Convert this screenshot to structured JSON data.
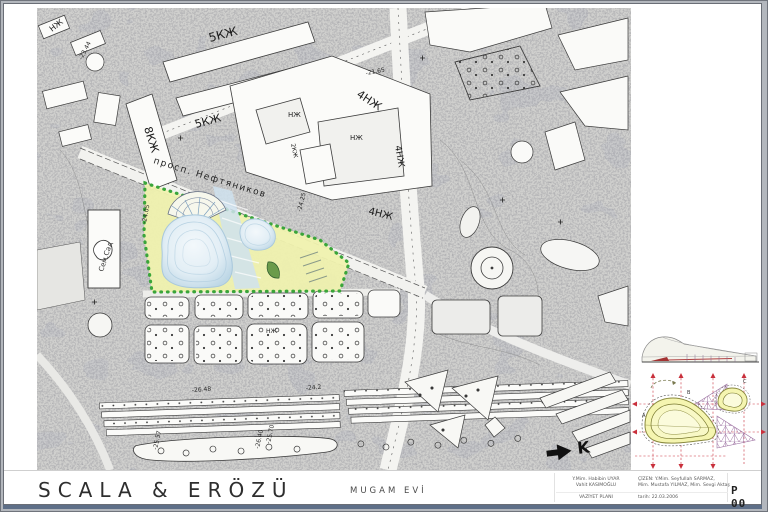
{
  "titleblock": {
    "firm": "SCALA & ERÖZÜ",
    "project": "MUGAM EVİ",
    "credits": {
      "left1": "Y.Mim. Habibin UYAR",
      "left2": "Vahit KASIMOĞLU",
      "left3": "VAZİYET PLANI",
      "right1": "ÇİZEN:  Y.Mim. Seyfullah SARMAZ,",
      "right2": "Mim. Mustafa YILMAZ, Mim. Sevgi Aktaş",
      "right3": "tarih: 22.03.2006"
    },
    "sheet": "P 00"
  },
  "map": {
    "street": "просп. Нефтяников",
    "garden": "Сем.Сад",
    "north": "K",
    "labels": [
      {
        "t": "НЖ"
      },
      {
        "t": "5КЖ"
      },
      {
        "t": "8КЖ"
      },
      {
        "t": "5КЖ"
      },
      {
        "t": "4НЖ"
      },
      {
        "t": "НЖ"
      },
      {
        "t": "НЖ"
      },
      {
        "t": "4НЖ"
      },
      {
        "t": "4НЖ"
      },
      {
        "t": "НЖ"
      },
      {
        "t": "2КЖ"
      }
    ],
    "elevations": [
      {
        "v": "-21.65"
      },
      {
        "v": "-24.25"
      },
      {
        "v": "-23.44"
      },
      {
        "v": "-26.48"
      },
      {
        "v": "-25.57"
      },
      {
        "v": "-26.40"
      },
      {
        "v": "-25.70"
      },
      {
        "v": "-24.2"
      },
      {
        "v": "-24.05"
      }
    ]
  },
  "diagram": {
    "a": "A",
    "b": "B",
    "c": "C"
  },
  "colors": {
    "site_yellow": "#eff1ae",
    "site_green": "#3aa53a",
    "path_blue": "#cfe2ee",
    "blob_edge": "#a9c8dc",
    "grid_red": "#c9303c",
    "lattice_purple": "#9b6fa0",
    "diagram_yellow": "#f5f5b0",
    "frame_gray": "#b3b7bd",
    "band_blue": "#5e6f88"
  }
}
